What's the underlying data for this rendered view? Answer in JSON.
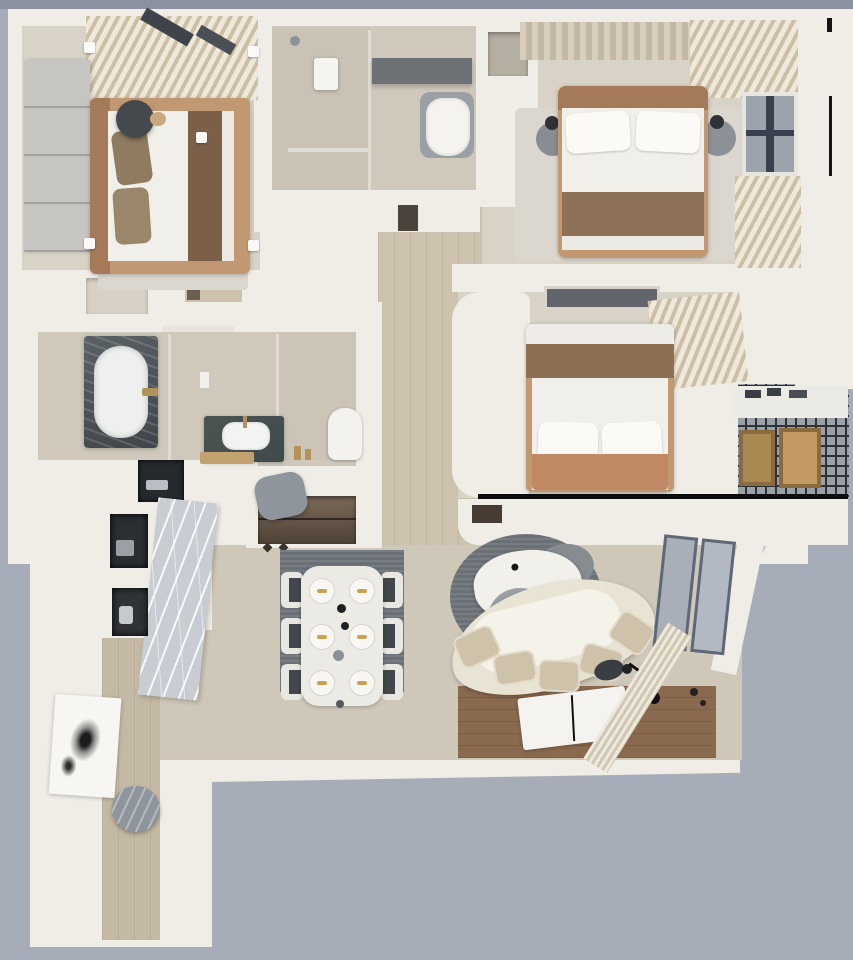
{
  "title": "3D rendered apartment floor plan (top-down dollhouse view)",
  "palette": {
    "bg": "#a7adb8",
    "bgTop": "#8b919e",
    "bgWedge": "#c4c8cf",
    "wall": "#f0ede7",
    "wallShade": "#ddd9d2",
    "floor": "#d8d2c7",
    "tile": "#cfc8bb",
    "wood": "#cdc2ae",
    "woodDark": "#8a6a4f",
    "entryWood": "#c4b9a5",
    "rugLight": "#dbd7cf",
    "rugDark": "#6b7077",
    "bedTan": "#c29872",
    "headboard": "#a57a58",
    "blanketBrown": "#8d7258",
    "blanketTan": "#c08a66",
    "pillowTaupe": "#8f7b60",
    "duvet": "#f1efe9",
    "sofaCream": "#e9e3d3",
    "cushion": "#cfc2ab",
    "marble": "#c9cdd3",
    "darkCounter": "#3f4a4a",
    "tubDark": "#474f52",
    "grayObj": "#8f959c",
    "glass": "#e0dcd4",
    "gold": "#b5915a",
    "windowGray": "#9ba3ad",
    "frameDark": "#5f6877",
    "gridLine": "#2e3136",
    "balcGray": "#9aa0a7",
    "crate": "#ab8752",
    "crateDark": "#8a6a3e",
    "curtainA": "#cdbfa6",
    "curtainB": "#efe9dc",
    "wardrobe": "#c7c5c1",
    "black": "#111111",
    "nicheDarkA": "#7b6a58",
    "nicheDarkB": "#4e4337",
    "applianceDark": "#26292e"
  },
  "rooms": {
    "bedroom_top_left": "Bedroom (top left) with wardrobe and double bed",
    "bathroom_top_center": "En-suite bathroom with shower, counter and toilet",
    "master_bedroom": "Master bedroom (top right) with double bed, nightstands and window",
    "bathroom_mid_left": "Main bathroom with bathtub, vanity sink and toilet",
    "hallway": "Central hallway with wood flooring",
    "bedroom_mid_right": "Third bedroom with vertical bed and curtains",
    "balcony": "Service balcony with lattice floor and wooden crates",
    "closet": "Closet niche with shelving and hooks",
    "kitchen_niche": "Kitchen cabinet column with appliance niches and marble panel",
    "dining": "Dining area with table for six on dark rug",
    "living": "Living area with curved sofa, coffee table and poufs",
    "tv_area": "Dark wood TV floor panel with flat TV board",
    "entry": "Entry corridor with artwork and round stool"
  },
  "furniture": {
    "beds": [
      "bed-top-left",
      "bed-master",
      "bed-mid-right"
    ],
    "bathroom_fixtures": [
      "bathtub",
      "vanity-sink",
      "toilet-main",
      "toilet-ensuite",
      "shower-panel",
      "glass-partitions"
    ],
    "dining_set": {
      "table_seats": 6,
      "plates": 6,
      "chairs": 6
    },
    "living_set": [
      "curved-sofa",
      "coffee-table",
      "pouf-large",
      "pouf-small",
      "rock-ottoman",
      "floor-lamp",
      "tv-panel",
      "sliding-door",
      "curtain"
    ],
    "balcony_set": [
      "counter",
      "crate-left",
      "crate-right"
    ],
    "decor": [
      "ink-artwork",
      "round-stool",
      "marble-panel",
      "white-corner-tags"
    ]
  },
  "annotations": {
    "white_tag_count": 5,
    "section_cut_line": "black horizontal line under mid-right bedroom",
    "window_edge_line": "thin black vertical line at right wall"
  }
}
